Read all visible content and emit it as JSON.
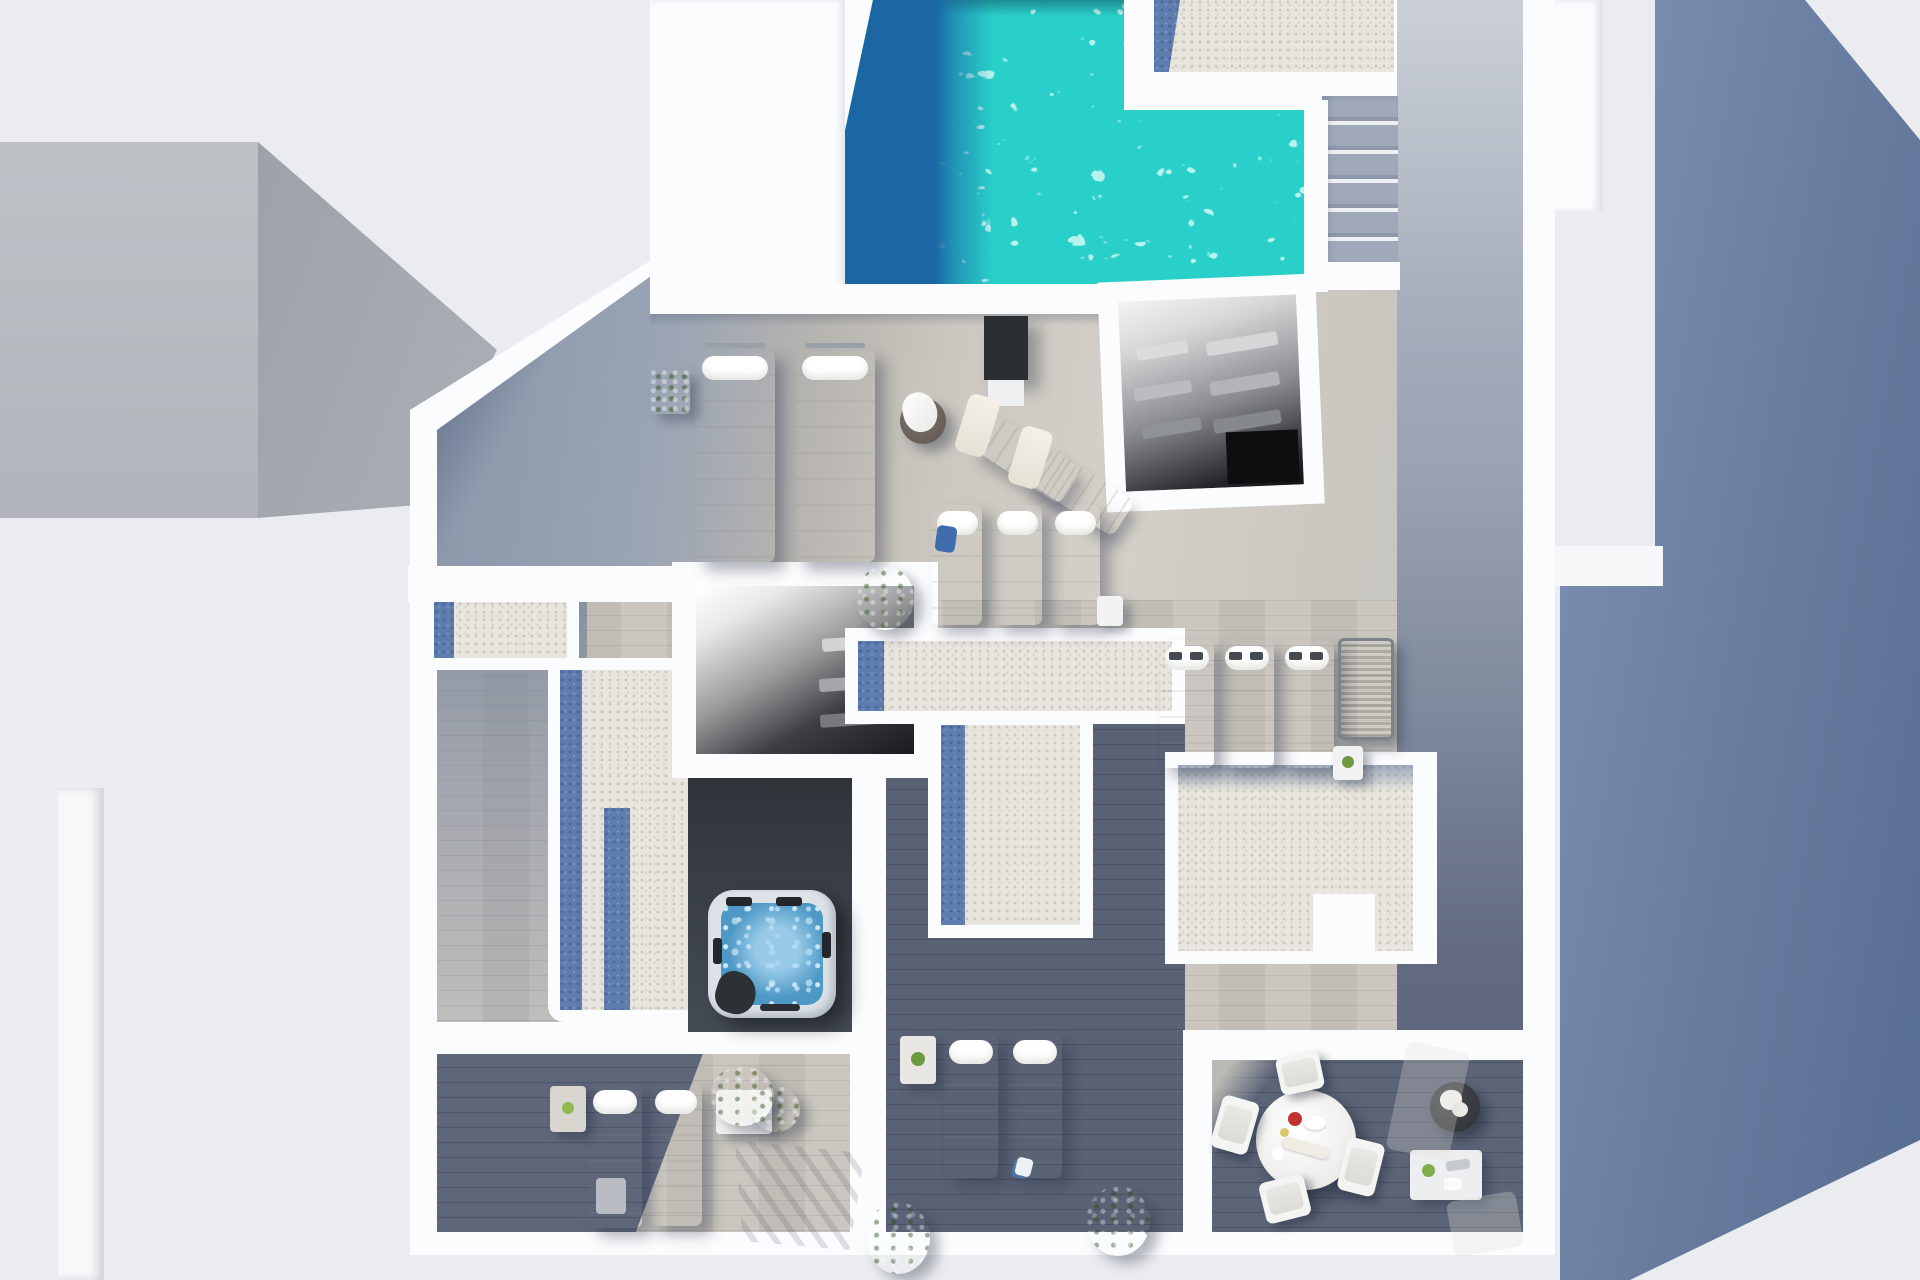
{
  "scene": {
    "title": "Top-down 3D render of a villa rooftop terrace with pool",
    "palette": {
      "bg": "#eaecef",
      "neighbor_block": "#b7bbc1",
      "neighbor_shadow": "#a5aab1",
      "wall": "#fbfcfd",
      "wood_sun": "#cfccc5",
      "wood_shadow": "#939eb1",
      "wood_dark": "#5b6376",
      "pool_water": "#29cfc9",
      "pool_deep": "#1a67a4",
      "gravel": "#e7e5de",
      "gravel_shadow": "#5e7dae",
      "slate_shadow": "#66799d",
      "interior_dark": "#1a1c1f",
      "platform_dark": "#383d44",
      "plant": "#7cab4b",
      "tub_water": "#4e98c6",
      "tub_shell": "#dde2e7",
      "accent_red": "#bf3430"
    },
    "labels": {
      "pool": "Swimming pool",
      "gravel_roof": "Gravel roof section",
      "stairs": "Outdoor staircase",
      "stairwell_mid": "Stairwell opening",
      "stairwell_east": "Slatted stairwell roof",
      "hot_tub": "Hot tub",
      "lounger": "Sun lounger",
      "chaise": "Deck chair",
      "mesh_lounger": "Mesh lounger",
      "dining_table": "Round dining table",
      "chair": "Dining chair",
      "plant": "Potted plant",
      "side_table": "Side table",
      "neighbor": "Neighbouring building",
      "shadow": "Cast shadow",
      "walkway": "Wooden walkway",
      "terrace": "Wood deck terrace",
      "planter": "Round planter with flowers",
      "shower_panel": "Pool shower panel"
    },
    "inventory": {
      "white_sun_loungers": 12,
      "deck_chairs": 2,
      "mesh_loungers": 1,
      "dining_chairs": 4,
      "plants": 7,
      "side_tables": 6,
      "hot_tubs": 1,
      "pools": 1
    }
  }
}
